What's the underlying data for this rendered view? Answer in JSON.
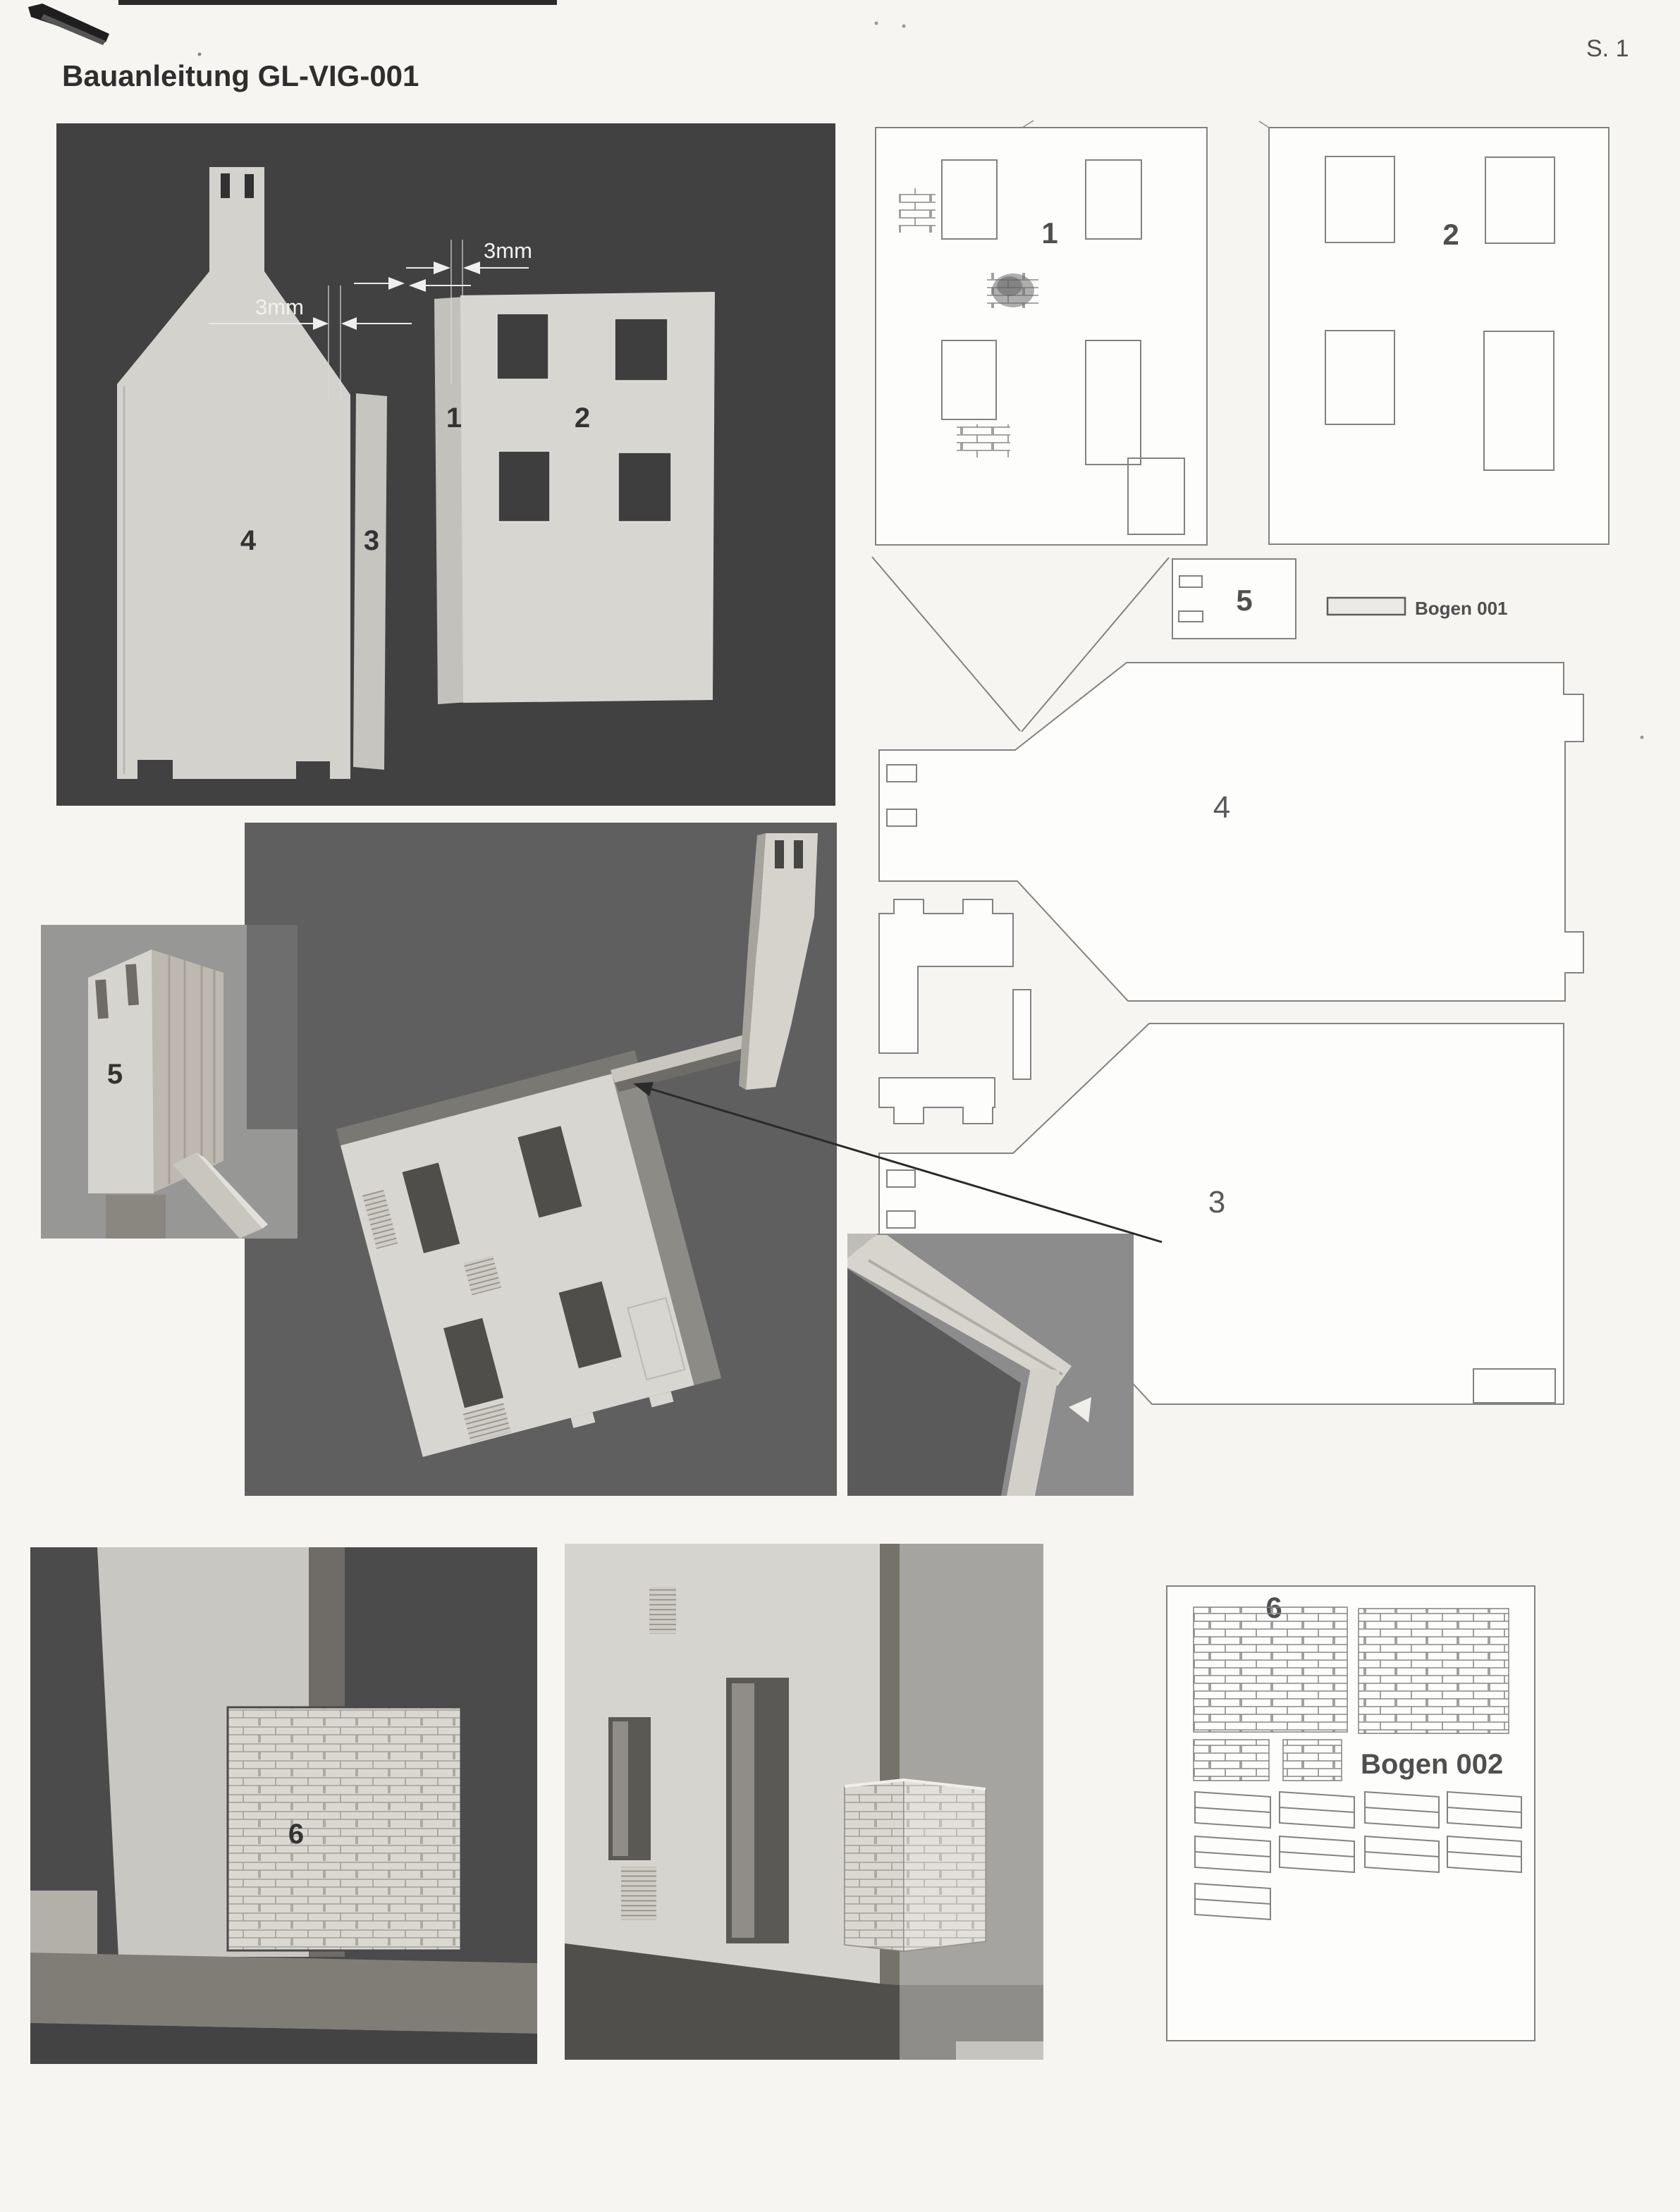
{
  "header": {
    "title": "Bauanleitung GL-VIG-001",
    "page": "S. 1"
  },
  "photo_parts": {
    "dim_a": "3mm",
    "dim_b": "3mm",
    "part4": "4",
    "part3": "3",
    "part1": "1",
    "part2": "2"
  },
  "sheet1": {
    "part1": "1",
    "part2": "2",
    "part5": "5",
    "part4": "4",
    "part3": "3",
    "bogen": "Bogen 001"
  },
  "photo_chimney": {
    "part5": "5"
  },
  "photo_brick": {
    "part6": "6"
  },
  "sheet2": {
    "part6": "6",
    "bogen": "Bogen 002"
  },
  "colors": {
    "photo_dark_bg": "#414141",
    "photo_mid_bg": "#5f5f5f",
    "piece_light": "#d7d5d0",
    "drawing_line": "#828282",
    "label_gray": "#555555"
  }
}
